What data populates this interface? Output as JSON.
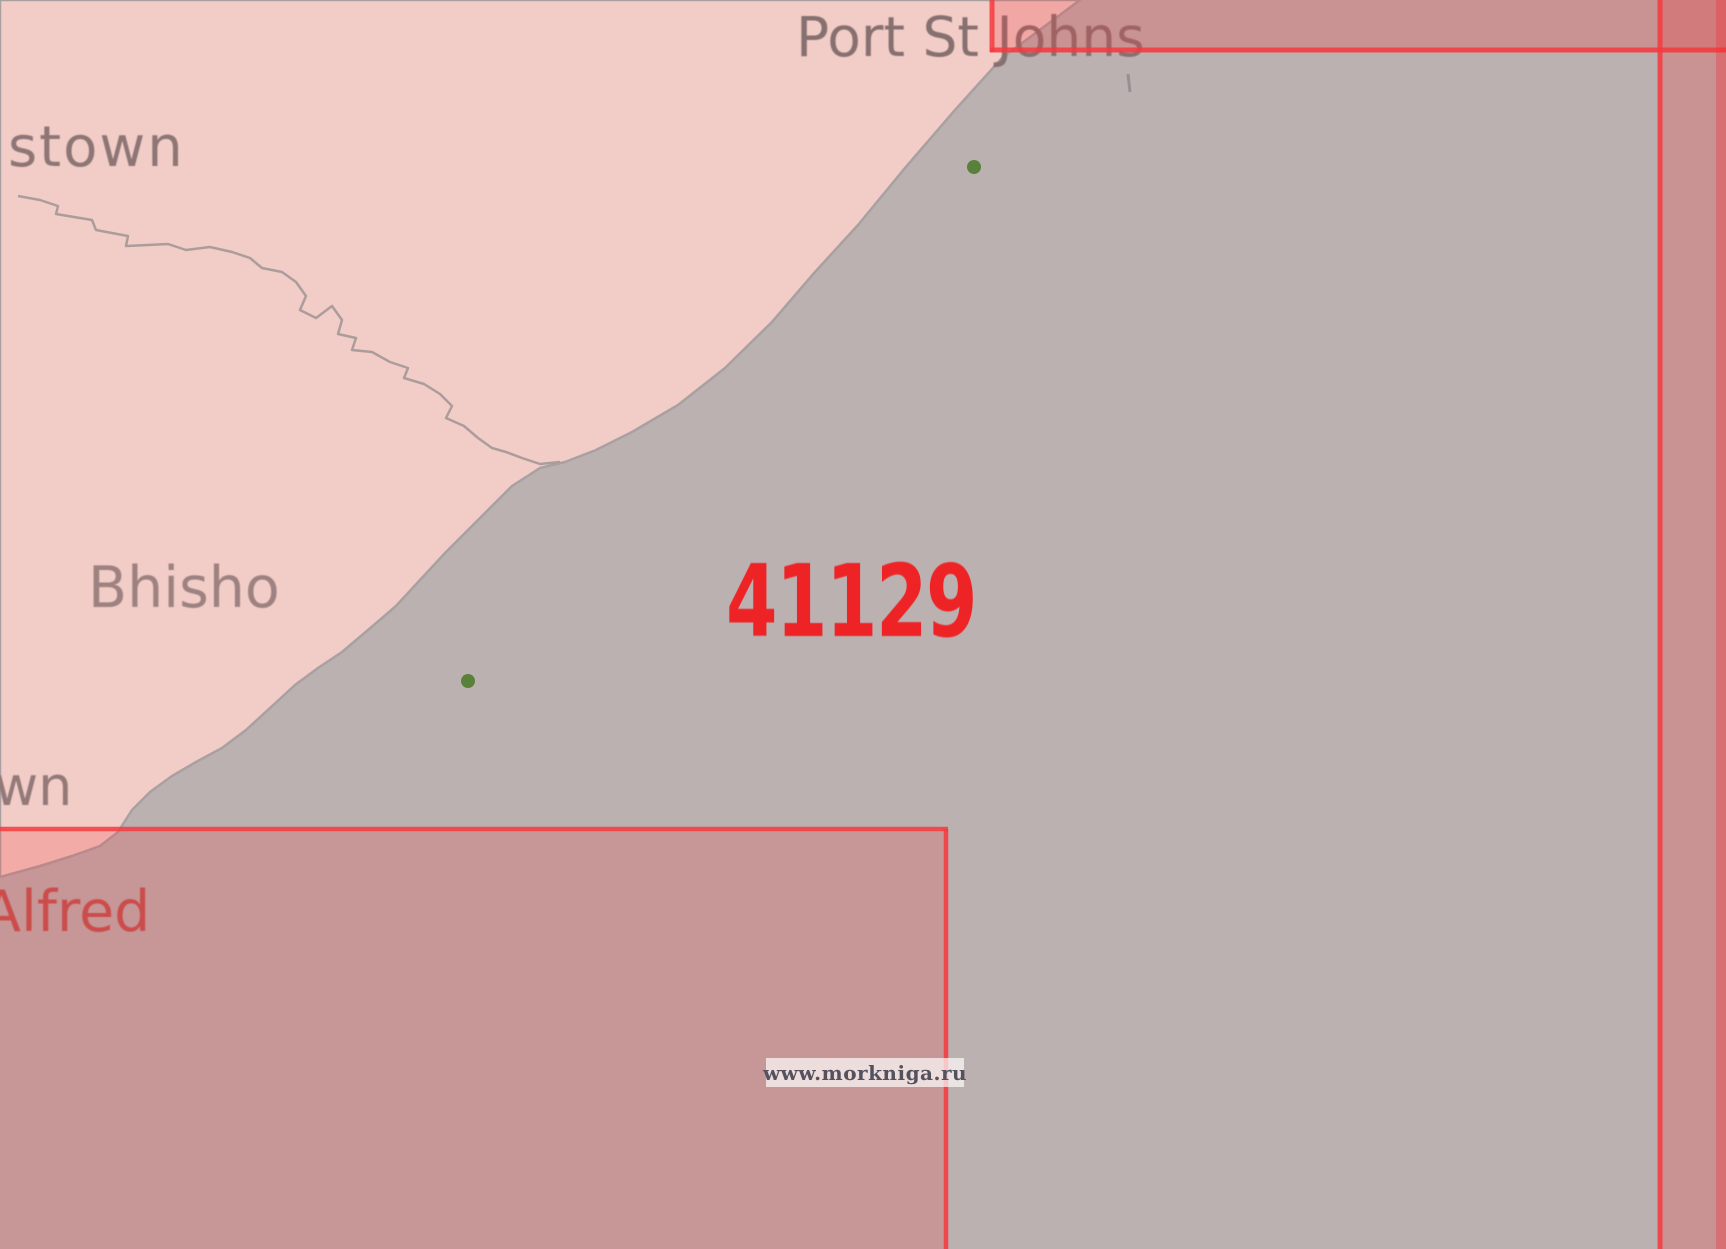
{
  "map": {
    "region_labels": [
      {
        "id": "queenstown-partial",
        "text": "stown"
      },
      {
        "id": "port-st-johns",
        "text": "Port St Johns"
      },
      {
        "id": "bhisho",
        "text": "Bhisho"
      },
      {
        "id": "town-partial",
        "text": "wn"
      },
      {
        "id": "port-alfred-partial",
        "text": "Alfred"
      }
    ],
    "chart_number": "41129",
    "markers": [
      {
        "id": "town-dot-port-st-johns"
      },
      {
        "id": "town-dot-coast-south"
      }
    ]
  },
  "watermark": {
    "text": "www.morkniga.ru"
  },
  "colors": {
    "land": "#f2ccc6",
    "sea": "#bcb1b1",
    "river": "#ab9d9c",
    "coast": "#a9a0a2",
    "overlay-red": "rgba(240,55,58,0.22)",
    "overlay-red-strong": "rgba(240,55,58,0.25)",
    "border-red": "rgba(244,58,62,0.85)",
    "chart-number-red": "#ee2326",
    "label-gray": "#8d7675",
    "alfred-red": "#c05450",
    "green-dot": "#4e7c2d",
    "watermark-text": "#54525f",
    "watermark-bg": "rgba(252,248,246,0.72)"
  }
}
